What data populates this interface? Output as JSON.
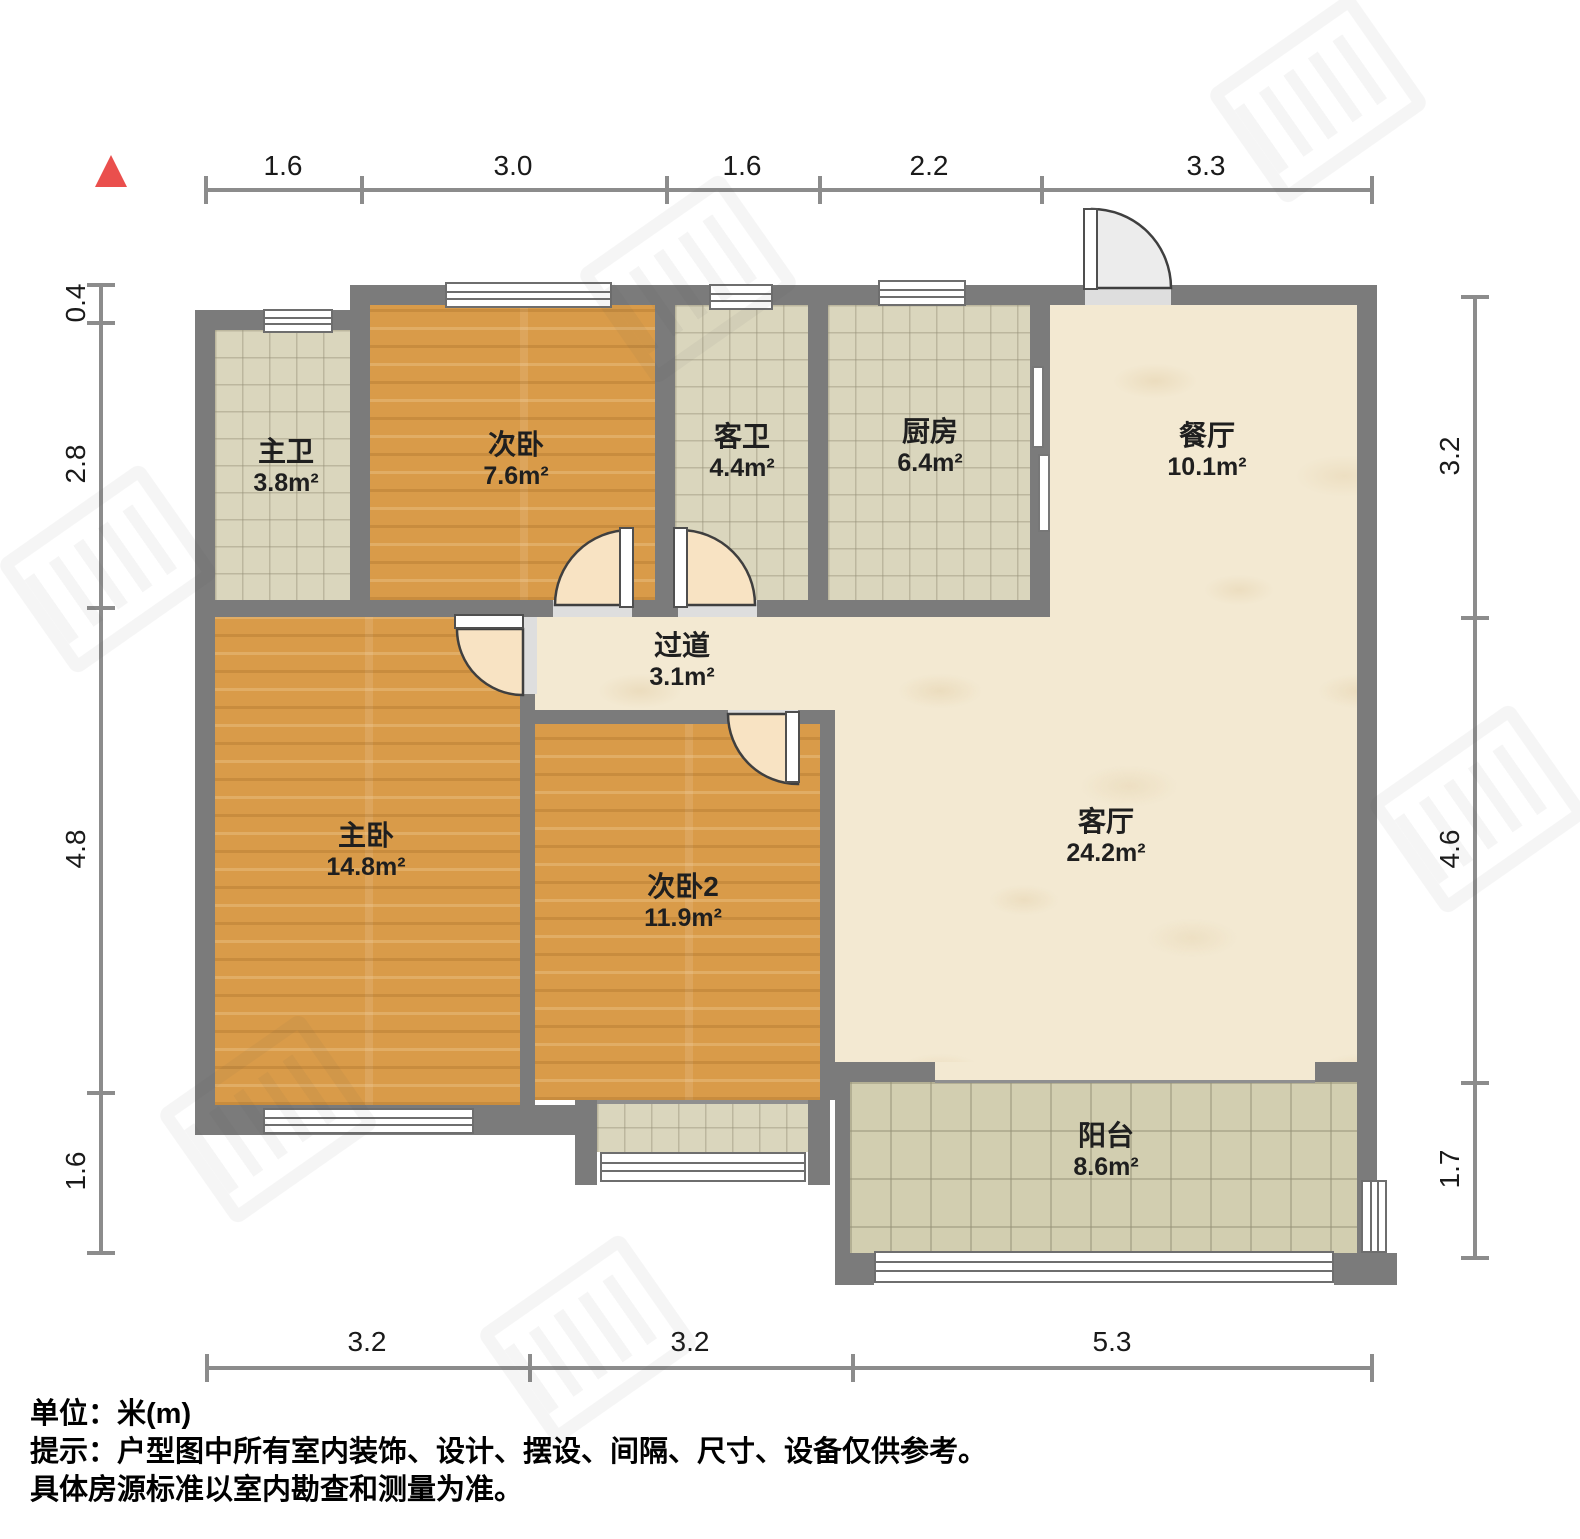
{
  "dimensions": {
    "top": [
      "1.6",
      "3.0",
      "1.6",
      "2.2",
      "3.3"
    ],
    "left": [
      "0.4",
      "2.8",
      "4.8",
      "1.6"
    ],
    "right": [
      "3.2",
      "4.6",
      "1.7"
    ],
    "bottom": [
      "3.2",
      "3.2",
      "5.3"
    ]
  },
  "rooms": [
    {
      "name": "主卫",
      "area": "3.8m²"
    },
    {
      "name": "次卧",
      "area": "7.6m²"
    },
    {
      "name": "客卫",
      "area": "4.4m²"
    },
    {
      "name": "厨房",
      "area": "6.4m²"
    },
    {
      "name": "餐厅",
      "area": "10.1m²"
    },
    {
      "name": "过道",
      "area": "3.1m²"
    },
    {
      "name": "主卧",
      "area": "14.8m²"
    },
    {
      "name": "次卧2",
      "area": "11.9m²"
    },
    {
      "name": "客厅",
      "area": "24.2m²"
    },
    {
      "name": "阳台",
      "area": "8.6m²"
    }
  ],
  "footer": {
    "unit": "单位：米(m)",
    "note1": "提示：户型图中所有室内装饰、设计、摆设、间隔、尺寸、设备仅供参考。",
    "note2": "具体房源标准以室内勘查和测量为准。"
  },
  "colors": {
    "wall": "#7b7b7b",
    "wood_floor": "#d99b49",
    "tile_floor": "#dad6bd",
    "marble_floor": "#f3e9d2",
    "north_arrow": "#ea4f4d",
    "dimension_line": "#8c8c8c"
  }
}
